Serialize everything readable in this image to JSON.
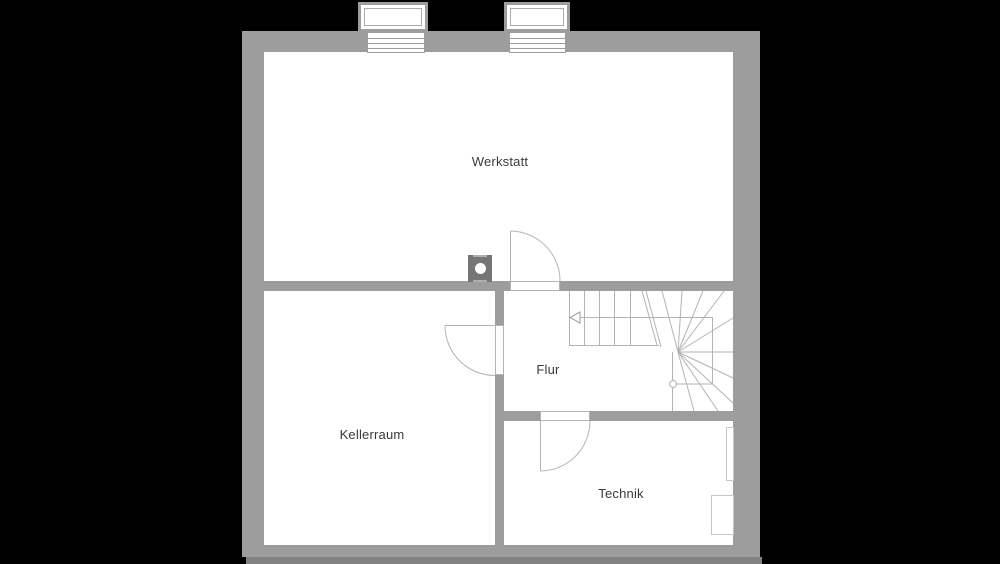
{
  "rooms": {
    "werkstatt": {
      "label": "Werkstatt"
    },
    "kellerraum": {
      "label": "Kellerraum"
    },
    "flur": {
      "label": "Flur"
    },
    "technik": {
      "label": "Technik"
    }
  },
  "symbols": {
    "windows": [
      "lightwell-window-left",
      "lightwell-window-right"
    ],
    "doors": [
      "werkstatt-door-swing",
      "kellerraum-door-swing",
      "technik-door-swing"
    ],
    "stairs": "winder-staircase-with-walkline-arrow",
    "chimney": "chimney-with-flue",
    "equipment": [
      "technik-wall-unit",
      "technik-floor-unit"
    ]
  },
  "colors": {
    "background": "#000000",
    "wall": "#9d9d9d",
    "floor": "#ffffff",
    "linework": "#b3b3b3",
    "chimney": "#767676",
    "ground_line": "#828282",
    "label_text": "#3a3a3a"
  }
}
